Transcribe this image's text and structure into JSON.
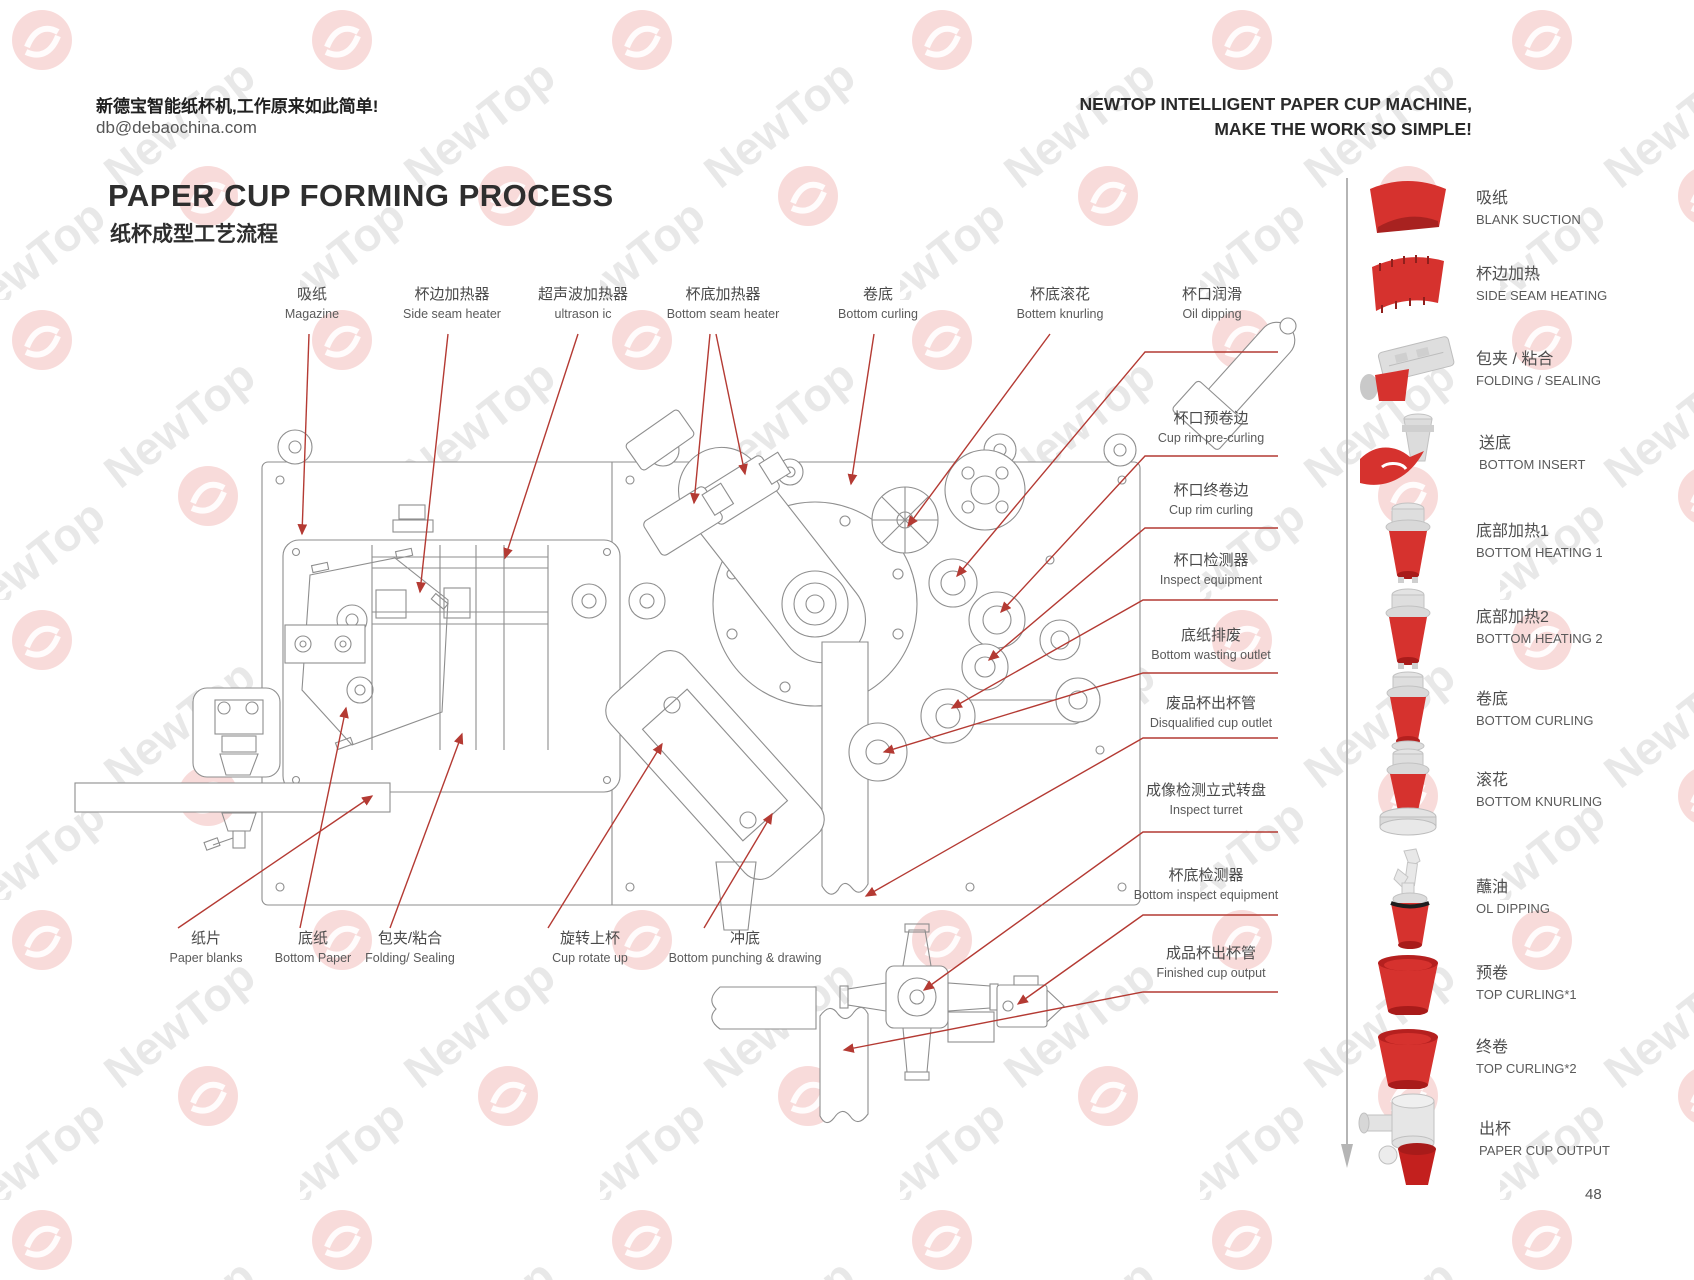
{
  "header": {
    "slogan_zh": "新德宝智能纸杯机,工作原来如此简单!",
    "email": "db@debaochina.com",
    "slogan_en_line1": "NEWTOP INTELLIGENT PAPER CUP MACHINE,",
    "slogan_en_line2": "MAKE THE WORK SO SIMPLE!"
  },
  "title": {
    "en": "PAPER CUP FORMING PROCESS",
    "zh": "纸杯成型工艺流程"
  },
  "diagram": {
    "labels": [
      {
        "id": "magazine",
        "zh": "吸纸",
        "en": "Magazine"
      },
      {
        "id": "side-seam-heater",
        "zh": "杯边加热器",
        "en": "Side seam heater"
      },
      {
        "id": "ultrasonic-heater",
        "zh": "超声波加热器",
        "en": "ultrason ic"
      },
      {
        "id": "bottom-seam-heater",
        "zh": "杯底加热器",
        "en": "Bottom seam heater"
      },
      {
        "id": "bottom-curling",
        "zh": "卷底",
        "en": "Bottom curling"
      },
      {
        "id": "bottom-knurling",
        "zh": "杯底滚花",
        "en": "Bottem knurling"
      },
      {
        "id": "oil-dipping",
        "zh": "杯口润滑",
        "en": "Oil dipping"
      },
      {
        "id": "cup-rim-pre-curling",
        "zh": "杯口预卷边",
        "en": "Cup rim pre-curling"
      },
      {
        "id": "cup-rim-curling",
        "zh": "杯口终卷边",
        "en": "Cup rim curling"
      },
      {
        "id": "inspect-equipment",
        "zh": "杯口检测器",
        "en": "Inspect equipment"
      },
      {
        "id": "bottom-wasting-outlet",
        "zh": "底纸排废",
        "en": "Bottom wasting outlet"
      },
      {
        "id": "disqualified-cup-outlet",
        "zh": "废品杯出杯管",
        "en": "Disqualified cup outlet"
      },
      {
        "id": "inspect-turret",
        "zh": "成像检测立式转盘",
        "en": "Inspect turret"
      },
      {
        "id": "bottom-inspect-equipment",
        "zh": "杯底检测器",
        "en": "Bottom inspect equipment"
      },
      {
        "id": "finished-cup-output",
        "zh": "成品杯出杯管",
        "en": "Finished cup output"
      },
      {
        "id": "paper-blanks",
        "zh": "纸片",
        "en": "Paper blanks"
      },
      {
        "id": "bottom-paper",
        "zh": "底纸",
        "en": "Bottom Paper"
      },
      {
        "id": "folding-sealing",
        "zh": "包夹/粘合",
        "en": "Folding/ Sealing"
      },
      {
        "id": "cup-rotate-up",
        "zh": "旋转上杯",
        "en": "Cup rotate up"
      },
      {
        "id": "bottom-punching",
        "zh": "冲底",
        "en": "Bottom punching & drawing"
      }
    ]
  },
  "sidebar": {
    "steps": [
      {
        "zh": "吸纸",
        "en": "BLANK SUCTION",
        "icon": "blank-suction-icon"
      },
      {
        "zh": "杯边加热",
        "en": "SIDE SEAM HEATING",
        "icon": "side-seam-heating-icon"
      },
      {
        "zh": "包夹 / 粘合",
        "en": "FOLDING / SEALING",
        "icon": "folding-sealing-icon"
      },
      {
        "zh": "送底",
        "en": "BOTTOM INSERT",
        "icon": "bottom-insert-icon"
      },
      {
        "zh": "底部加热1",
        "en": "BOTTOM HEATING 1",
        "icon": "bottom-heating-1-icon"
      },
      {
        "zh": "底部加热2",
        "en": "BOTTOM HEATING 2",
        "icon": "bottom-heating-2-icon"
      },
      {
        "zh": "卷底",
        "en": "BOTTOM CURLING",
        "icon": "bottom-curling-icon"
      },
      {
        "zh": "滚花",
        "en": "BOTTOM KNURLING",
        "icon": "bottom-knurling-icon"
      },
      {
        "zh": "蘸油",
        "en": "OL DIPPING",
        "icon": "oil-dipping-icon"
      },
      {
        "zh": "预卷",
        "en": "TOP CURLING*1",
        "icon": "top-curling-1-icon"
      },
      {
        "zh": "终卷",
        "en": "TOP CURLING*2",
        "icon": "top-curling-2-icon"
      },
      {
        "zh": "出杯",
        "en": "PAPER CUP OUTPUT",
        "icon": "paper-cup-output-icon"
      }
    ]
  },
  "page_number": "48",
  "colors": {
    "leader_red": "#b43a33",
    "cup_red": "#d6322e",
    "logo_red": "#e25552",
    "line_gray": "#8e8e8e"
  }
}
